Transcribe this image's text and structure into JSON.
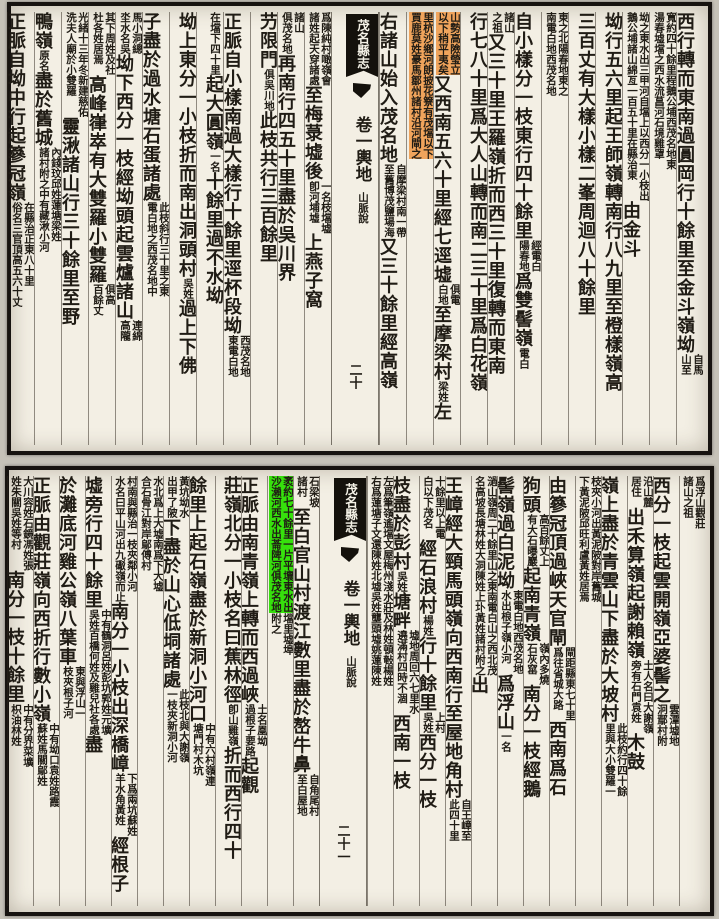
{
  "palette": {
    "canvas_bg": "#c6c2b8",
    "page_bg": "#f3efe4",
    "ink": "#201c15",
    "frame": "#171310",
    "tag_bg": "#14110c",
    "tag_text": "#f4f1e6",
    "orange_highlight": "#f0a45c",
    "green_highlight": "#36e10c"
  },
  "pages": [
    {
      "id": "top-page",
      "banxin": {
        "title": "茂名縣志",
        "juan": "卷一輿地",
        "section": "山脈說",
        "page_number": "二十"
      },
      "right_columns": [
        {
          "runs": [
            {
              "m": "西行轉而東南過圓岡行十餘里至金斗嶺坳"
            },
            {
              "n": [
                "自馬",
                "山至"
              ]
            }
          ]
        },
        {
          "runs": [
            {
              "n": [
                "寬約四十餘里程鵝公埔西茂名地東",
                "湯春墟壋之西水流菖河石境雞罩"
              ]
            }
          ]
        },
        {
          "runs": [
            {
              "n": [
                "坳之東水出三甲河自壋上以西分一小枝出",
                "鵝公埔諸山綿亙一百五十里在縣治東"
              ]
            },
            {
              "m": "由金斗"
            }
          ]
        },
        {
          "runs": [
            {
              "m": "坳行五六里起王師嶺轉南行八九里至橙樣嶺高"
            }
          ]
        },
        {
          "runs": [
            {
              "m": "三百丈有大樣小樣二峯周迴八十餘里"
            }
          ]
        },
        {
          "runs": [
            {
              "n": [
                "東之北陽春地東之",
                "南電白地西茂名地"
              ]
            }
          ]
        },
        {
          "runs": [
            {
              "m": "自小樣分一枝東行四十餘里"
            },
            {
              "n": [
                "經電白",
                "陽春地"
              ]
            },
            {
              "m": "爲雙髻嶺"
            },
            {
              "n": [
                "電白"
              ]
            }
          ]
        },
        {
          "runs": [
            {
              "n": [
                "諸山",
                "之祖"
              ]
            },
            {
              "m": "又三十里王羅嶺折而西三十里復轉而東南"
            }
          ]
        },
        {
          "runs": [
            {
              "m": "行七八十里爲大人山轉而南二三十里爲白花嶺"
            }
          ]
        },
        {
          "runs": [
            {
              "n": [
                "山勢高險瑩立",
                "以下稍平夷矣"
              ],
              "hl": "orange"
            },
            {
              "m": "又西南五六十里經七逕墟"
            },
            {
              "n": [
                "俱電",
                "白地"
              ]
            },
            {
              "m": "至摩梁村"
            },
            {
              "n": [
                "梁姓"
              ]
            },
            {
              "m": "左"
            }
          ]
        },
        {
          "runs": [
            {
              "n": [
                "里杭沙鄉河朗披花簝有茂壋以下",
                "買鹿莫姓豪馬鄒州諸村沿河閘之"
              ],
              "hl": "orange"
            }
          ]
        },
        {
          "runs": [
            {
              "m": "右諸山始入茂名地"
            },
            {
              "n": [
                "自摩梁村南一帶",
                "至舊博茂鹽場海"
              ]
            },
            {
              "m": "又三十餘里經高嶺"
            },
            {
              "n": [
                "一名稿高石下",
                "乃平吉墟巴張村"
              ]
            }
          ]
        }
      ],
      "left_columns": [
        {
          "runs": [
            {
              "n": [
                "爲陳純村噉嶺會",
                "諸姓起天穿諸處"
              ]
            },
            {
              "m": "至梅菉墟後"
            },
            {
              "n": [
                "一名枝壋墟",
                "卽河埔墟"
              ]
            },
            {
              "m": "上燕子窩"
            }
          ]
        },
        {
          "runs": [
            {
              "n": [
                "諸山",
                "俱茂名地"
              ]
            },
            {
              "m": "再南行四五十里盡於吳川界"
            }
          ]
        },
        {
          "runs": [
            {
              "m": "芀限門"
            },
            {
              "n": [
                "俱吳川地"
              ]
            },
            {
              "m": "此枝共行三百餘里"
            }
          ]
        },
        {
          "runs": [
            {
              "m": "正脈自小樣南過大樣行十餘里逕杯段坳"
            },
            {
              "n": [
                "西茂名地",
                "東電白地"
              ]
            }
          ]
        },
        {
          "runs": [
            {
              "n": [
                "在壋下四十里"
              ]
            },
            {
              "m": "起大圓嶺"
            },
            {
              "n": [
                "一名"
              ]
            },
            {
              "m": "十餘里過不水坳"
            }
          ]
        },
        {
          "runs": [
            {
              "m": "坳上東分一小枝折而南出洞頭村"
            },
            {
              "n": [
                "吳姓"
              ]
            },
            {
              "m": "過上下佛"
            }
          ]
        },
        {
          "runs": [
            {
              "m": "子盡於過水塘石蛋諸處"
            },
            {
              "n": [
                "此枝斜行三十里之東",
                "電白地之西茂名地中"
              ]
            }
          ]
        },
        {
          "runs": [
            {
              "n": [
                "馬小洞總",
                "坔水名吳"
              ]
            },
            {
              "m": "坳下西分一枝經坳頭起雲爐諸山"
            },
            {
              "n": [
                "連綿",
                "高隴"
              ]
            }
          ]
        },
        {
          "runs": [
            {
              "n": [
                "其下周姓及社",
                "杜各姓居焉"
              ]
            },
            {
              "m": "高峰嵂崒有大雙羅小雙羅"
            },
            {
              "n": [
                "俱高",
                "百餘丈"
              ]
            }
          ]
        },
        {
          "runs": [
            {
              "n": [
                "光緒十三年冬新建慈佑",
                "洗夫人廟於小雙羅"
              ]
            },
            {
              "m": "靈湫諸山行三十餘里至野"
            }
          ]
        },
        {
          "runs": [
            {
              "m": "鴨嶺"
            },
            {
              "n": [
                "原名"
              ]
            },
            {
              "m": "盡於舊城"
            },
            {
              "n": [
                "內錢玟邱姓蓮塘梁姓",
                "諸村附之中有藏湫小河"
              ]
            }
          ]
        },
        {
          "runs": [
            {
              "m": "正脈自坳中行起篸冠嶺"
            },
            {
              "n": [
                "在縣治正東八十里",
                "俗名三官頂高五六十丈"
              ]
            }
          ]
        }
      ]
    },
    {
      "id": "bottom-page",
      "banxin": {
        "title": "茂名縣志",
        "juan": "卷一輿地",
        "section": "山脈說",
        "page_number": "二十一"
      },
      "right_columns": [
        {
          "runs": [
            {
              "n": [
                "爲浮山觀莊",
                "諸山之祖"
              ]
            }
          ]
        },
        {
          "runs": [
            {
              "m": "西分一枝起雲開嶺亞婆髻之"
            },
            {
              "n": [
                "雲潭墟地",
                "泂鄢村附"
              ]
            }
          ]
        },
        {
          "runs": [
            {
              "n": [
                "沿山麓",
                "居住"
              ]
            },
            {
              "m": "出禾算嶺起謝賴嶺"
            },
            {
              "n": [
                "土人名曰大謝嶺",
                "旁有石門袁姓"
              ]
            },
            {
              "m": "木鼓"
            }
          ]
        },
        {
          "runs": [
            {
              "m": "嶺上盡於青雲山下盡於大坡村"
            },
            {
              "n": [
                "此枝約行四十餘",
                "里與大小雙羅一"
              ]
            }
          ]
        },
        {
          "runs": [
            {
              "n": [
                "枝夾小河出黃泥陂對岸舊城",
                "下黃泥陂邱旺利盧黃姓居焉"
              ]
            }
          ]
        },
        {
          "runs": [
            {
              "m": "由篸冠頂過峽天官閘"
            },
            {
              "n": [
                "閘距縣東七十里",
                "爲往省城大路"
              ]
            },
            {
              "m": "西南爲石"
            }
          ]
        },
        {
          "runs": [
            {
              "m": "狗頭"
            },
            {
              "n": [
                "高百餘丈上",
                "有大石曝巖"
              ]
            },
            {
              "m": "起南青嶺"
            },
            {
              "n": [
                "嶺內多燒",
                "石灰窰"
              ]
            },
            {
              "m": "南分一枝經鵝"
            }
          ]
        },
        {
          "runs": [
            {
              "m": "髻嶺過白泥坳"
            },
            {
              "n": [
                "東電白地西茂名地",
                "水出桹子嶺小河"
              ]
            },
            {
              "m": "爲浮山"
            },
            {
              "n": [
                "一名"
              ]
            }
          ]
        },
        {
          "runs": [
            {
              "n": [
                "濄山嶺周二十餘里山之東南電白山之西北茂",
                "名高坡長塘林姓大洞陳姓上圤黃姓諸村附之"
              ]
            },
            {
              "m": "出"
            }
          ]
        },
        {
          "runs": [
            {
              "m": "王嶂經大頸馬頭嶺向西南行至屋地角村"
            },
            {
              "n": [
                "自王嶂至",
                "此四十里"
              ]
            }
          ]
        },
        {
          "runs": [
            {
              "n": [
                "十餘里以上電",
                "白以下茂名"
              ]
            },
            {
              "m": "經石浪村"
            },
            {
              "n": [
                "楊姓"
              ]
            },
            {
              "m": "行十餘里"
            },
            {
              "n": [
                "上村",
                "吳姓"
              ]
            },
            {
              "m": "西分一枝"
            }
          ]
        },
        {
          "runs": [
            {
              "m": "枝盡於彭村"
            },
            {
              "n": [
                "吳姓"
              ]
            },
            {
              "m": "塘畔"
            },
            {
              "n": [
                "墟地周回六七里水",
                "遶滿村四時不涸"
              ]
            },
            {
              "m": "西南一枝"
            }
          ]
        },
        {
          "runs": [
            {
              "n": [
                "左爲筆嶺遙壋文屋梅州淺水莊及林姓頓㪑楊姓",
                "右爲蓮塘子文還陳姓北墟吳姓壟頭墟姚蓮陳姓"
              ]
            }
          ]
        }
      ],
      "left_columns": [
        {
          "runs": [
            {
              "n": [
                "石梁坡",
                "諸村"
              ]
            },
            {
              "m": "至白官山村渡江數里盡於嶅牛鼻"
            },
            {
              "n": [
                "自角尾村",
                "至白屋地"
              ]
            }
          ]
        },
        {
          "runs": [
            {
              "n": [
                "袤約七十餘里一片平壤東水出",
                "沙瀨河西水出菕陴河俱茂名地"
              ],
              "hl": "green"
            },
            {
              "n": [
                "壋里墟埠",
                "附之"
              ]
            }
          ]
        },
        {
          "runs": [
            {
              "m": "正脈由南青嶺上轉而西過峽"
            },
            {
              "n": [
                "土名凰坳",
                "過根子要路"
              ]
            },
            {
              "m": "起觀"
            }
          ]
        },
        {
          "runs": [
            {
              "m": "莊嶺北分一小枝名曰蕉林徑"
            },
            {
              "n": [
                "卽山雞嶺"
              ]
            },
            {
              "m": "折而西行四十"
            }
          ]
        },
        {
          "runs": [
            {
              "m": "餘里上起石嶺盡於新洞小河口"
            },
            {
              "n": [
                "中有六村嶺連",
                "塘門村木坑"
              ]
            }
          ]
        },
        {
          "runs": [
            {
              "n": [
                "黃坑坳水",
                "出甲了陂"
              ]
            },
            {
              "m": "下盡於山心低垌諸處"
            },
            {
              "n": [
                "此枝北與大謝嶺",
                "一枝夾新洞小河"
              ]
            }
          ]
        },
        {
          "runs": [
            {
              "n": [
                "水北爲上大墟南爲下大墟",
                "合石骨江對岸鄔傅村"
              ]
            }
          ]
        },
        {
          "runs": [
            {
              "n": [
                "村南與縣治一枝夾鄰小河",
                "水名曰平山河出九礟嶺而止"
              ]
            },
            {
              "m": "南分一小枝出深橋嶂"
            },
            {
              "n": [
                "下爲兩坑蘇姓",
                "羊水角黃姓"
              ]
            },
            {
              "m": "經根子"
            }
          ]
        },
        {
          "runs": [
            {
              "m": "墟旁行四十餘里"
            },
            {
              "n": [
                "中有鶴洞呂姓彭坑郭姓元壙",
                "吳姓百橋何姓及雞兒社各處"
              ]
            },
            {
              "m": "盡"
            }
          ]
        },
        {
          "runs": [
            {
              "m": "於灘底河雞公嶺八葉車"
            },
            {
              "n": [
                "東與浮山一",
                "枝夾根子河"
              ]
            }
          ]
        },
        {
          "runs": [
            {
              "m": "正脈由觀莊嶺向西折行數小嶺"
            },
            {
              "n": [
                "中有坳口袁姓路霞",
                "蘇姓馬關鄔姓"
              ]
            }
          ]
        },
        {
          "runs": [
            {
              "n": [
                "大川容姓石鏡馮姓張",
                "姓朱關吳姓等村"
              ]
            },
            {
              "m": "南分一枝十餘里"
            },
            {
              "n": [
                "中有分界菜壙",
                "枳油林姓"
              ]
            }
          ]
        }
      ]
    }
  ]
}
